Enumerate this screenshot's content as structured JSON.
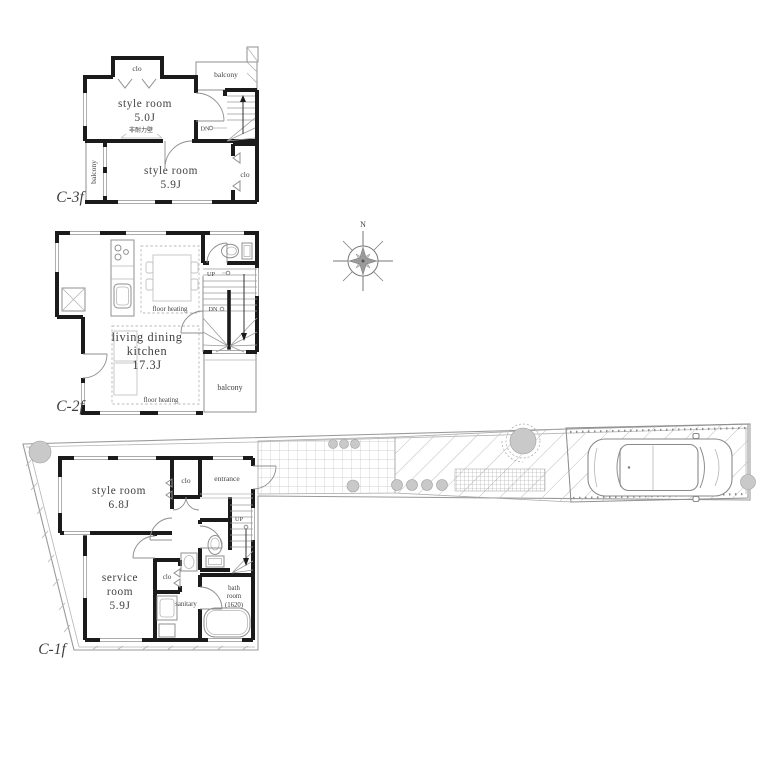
{
  "colors": {
    "wall": "#1b1b1b",
    "line": "#8f8f8f",
    "text": "#3f3f3f",
    "shrub": "#c9c9c9",
    "background": "#ffffff"
  },
  "compass": {
    "north": "N"
  },
  "floor3": {
    "label": "C-3f",
    "closet_top": "clo",
    "balcony_top": "balcony",
    "room_a_line1": "style room",
    "room_a_line2": "5.0J",
    "wall_note": "非耐力壁",
    "stairs_down": "DN",
    "room_b_line1": "style room",
    "room_b_line2": "5.9J",
    "balcony_left": "balcony",
    "closet_right": "clo"
  },
  "floor2": {
    "label": "C-2f",
    "stairs_up": "UP",
    "stairs_down": "DN",
    "floor_heating_upper": "floor heating",
    "floor_heating_lower": "floor heating",
    "ldk_line1": "living dining",
    "ldk_line2": "kitchen",
    "ldk_line3": "17.3J",
    "balcony": "balcony"
  },
  "floor1": {
    "label": "C-1f",
    "room_line1": "style room",
    "room_line2": "6.8J",
    "closet_top": "clo",
    "entrance": "entrance",
    "stairs_up": "UP",
    "service_line1": "service",
    "service_line2": "room",
    "service_line3": "5.9J",
    "closet_small": "clo",
    "sanitary": "sanitary",
    "bath_line1": "bath",
    "bath_line2": "room",
    "bath_line3": "(1620)"
  }
}
